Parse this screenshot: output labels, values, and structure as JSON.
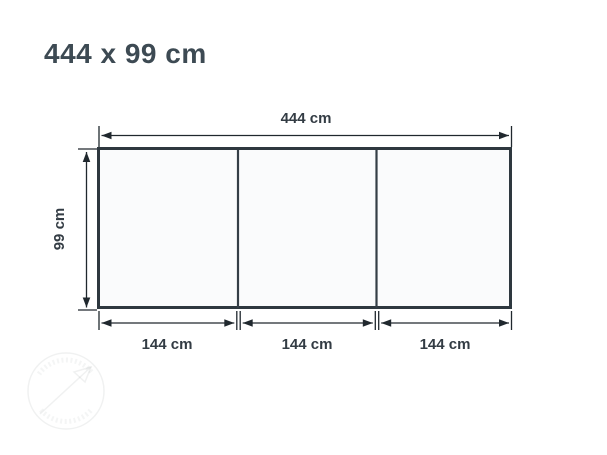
{
  "title": "444 x 99 cm",
  "dimensions": {
    "width_label": "444 cm",
    "height_label": "99 cm",
    "segment_labels": [
      "144 cm",
      "144 cm",
      "144 cm"
    ]
  },
  "panels": {
    "count": 3
  },
  "colors": {
    "title_text": "#3d4a53",
    "dimension_text": "#333c44",
    "dimension_line": "#20282e",
    "panel_border": "#2e383f",
    "panel_fill": "#fafbfc",
    "background": "#ffffff"
  }
}
